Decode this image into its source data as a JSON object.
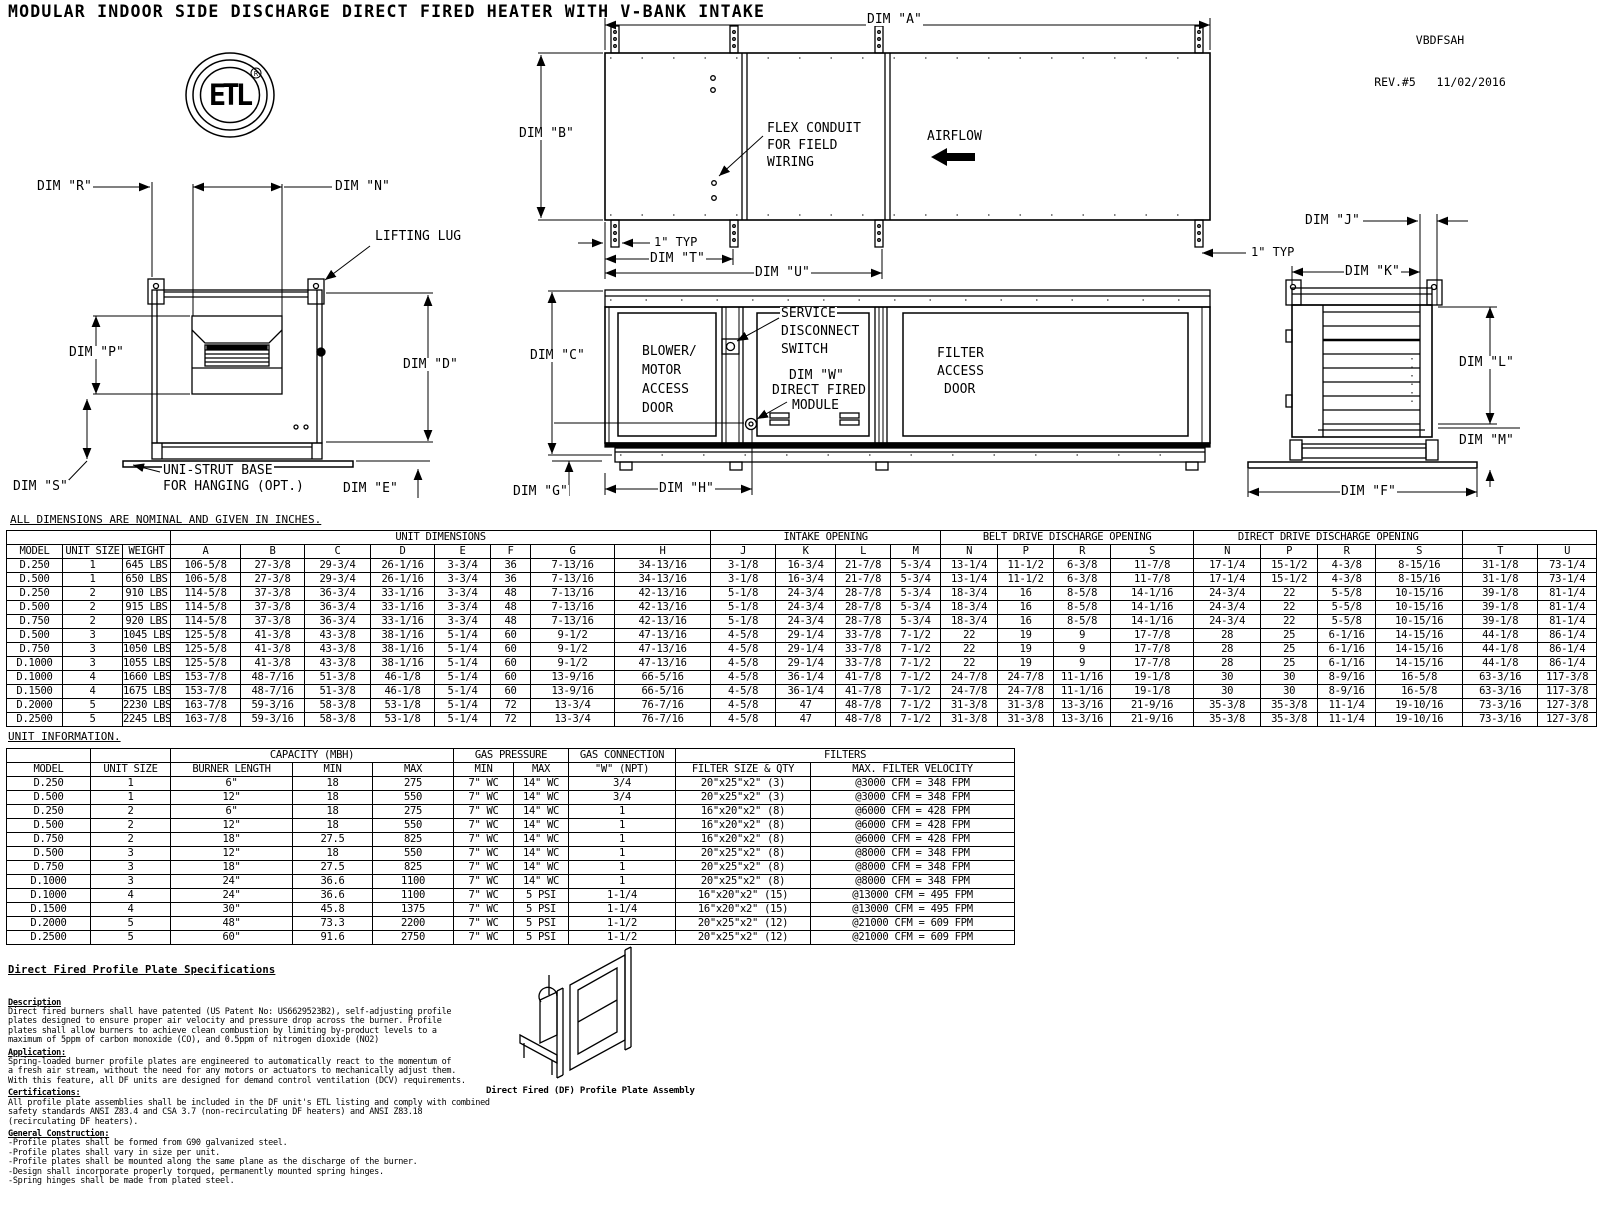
{
  "meta": {
    "title": "MODULAR INDOOR SIDE DISCHARGE DIRECT FIRED HEATER WITH V-BANK INTAKE",
    "doc_code": "VBDFSAH",
    "revision": "REV.#5   11/02/2016"
  },
  "logo": {
    "monogram": "ETL",
    "registered_mark": "R"
  },
  "notes": {
    "dimensions_note": "ALL DIMENSIONS ARE NOMINAL AND GIVEN IN INCHES.",
    "unit_info_note": "UNIT INFORMATION."
  },
  "drawing_labels": {
    "dim_r": "DIM \"R\"",
    "dim_n": "DIM \"N\"",
    "lifting_lug": "LIFTING LUG",
    "dim_p": "DIM \"P\"",
    "dim_d": "DIM \"D\"",
    "dim_s": "DIM \"S\"",
    "uni_strut_1": "UNI-STRUT BASE",
    "uni_strut_2": "FOR HANGING (OPT.)",
    "dim_e": "DIM \"E\"",
    "dim_a": "DIM \"A\"",
    "dim_b": "DIM \"B\"",
    "flex_1": "FLEX CONDUIT",
    "flex_2": "FOR FIELD",
    "flex_3": "WIRING",
    "airflow": "AIRFLOW",
    "typ_1": "1\" TYP",
    "dim_t": "DIM \"T\"",
    "dim_u": "DIM \"U\"",
    "dim_c": "DIM \"C\"",
    "blower_1": "BLOWER/",
    "blower_2": "MOTOR",
    "blower_3": "ACCESS",
    "blower_4": "DOOR",
    "service_1": "SERVICE",
    "service_2": "DISCONNECT",
    "service_3": "SWITCH",
    "dim_w": "DIM \"W\"",
    "df_1": "DIRECT FIRED",
    "df_2": "MODULE",
    "filter_1": "FILTER",
    "filter_2": "ACCESS",
    "filter_3": "DOOR",
    "dim_g": "DIM \"G\"",
    "dim_h": "DIM \"H\"",
    "dim_j": "DIM \"J\"",
    "typ_2": "1\" TYP",
    "dim_k": "DIM \"K\"",
    "dim_l": "DIM \"L\"",
    "dim_m": "DIM \"M\"",
    "dim_f": "DIM \"F\""
  },
  "dim_table": {
    "group_headers": [
      {
        "label": "",
        "span": 3
      },
      {
        "label": "UNIT DIMENSIONS",
        "span": 8
      },
      {
        "label": "INTAKE OPENING",
        "span": 4
      },
      {
        "label": "BELT DRIVE DISCHARGE OPENING",
        "span": 4
      },
      {
        "label": "DIRECT DRIVE DISCHARGE OPENING",
        "span": 4
      },
      {
        "label": "",
        "span": 2
      }
    ],
    "columns": [
      "MODEL",
      "UNIT SIZE",
      "WEIGHT",
      "A",
      "B",
      "C",
      "D",
      "E",
      "F",
      "G",
      "H",
      "J",
      "K",
      "L",
      "M",
      "N",
      "P",
      "R",
      "S",
      "N",
      "P",
      "R",
      "S",
      "T",
      "U"
    ],
    "rows": [
      [
        "D.250",
        "1",
        "645 LBS",
        "106-5/8",
        "27-3/8",
        "29-3/4",
        "26-1/16",
        "3-3/4",
        "36",
        "7-13/16",
        "34-13/16",
        "3-1/8",
        "16-3/4",
        "21-7/8",
        "5-3/4",
        "13-1/4",
        "11-1/2",
        "6-3/8",
        "11-7/8",
        "17-1/4",
        "15-1/2",
        "4-3/8",
        "8-15/16",
        "31-1/8",
        "73-1/4"
      ],
      [
        "D.500",
        "1",
        "650 LBS",
        "106-5/8",
        "27-3/8",
        "29-3/4",
        "26-1/16",
        "3-3/4",
        "36",
        "7-13/16",
        "34-13/16",
        "3-1/8",
        "16-3/4",
        "21-7/8",
        "5-3/4",
        "13-1/4",
        "11-1/2",
        "6-3/8",
        "11-7/8",
        "17-1/4",
        "15-1/2",
        "4-3/8",
        "8-15/16",
        "31-1/8",
        "73-1/4"
      ],
      [
        "D.250",
        "2",
        "910 LBS",
        "114-5/8",
        "37-3/8",
        "36-3/4",
        "33-1/16",
        "3-3/4",
        "48",
        "7-13/16",
        "42-13/16",
        "5-1/8",
        "24-3/4",
        "28-7/8",
        "5-3/4",
        "18-3/4",
        "16",
        "8-5/8",
        "14-1/16",
        "24-3/4",
        "22",
        "5-5/8",
        "10-15/16",
        "39-1/8",
        "81-1/4"
      ],
      [
        "D.500",
        "2",
        "915 LBS",
        "114-5/8",
        "37-3/8",
        "36-3/4",
        "33-1/16",
        "3-3/4",
        "48",
        "7-13/16",
        "42-13/16",
        "5-1/8",
        "24-3/4",
        "28-7/8",
        "5-3/4",
        "18-3/4",
        "16",
        "8-5/8",
        "14-1/16",
        "24-3/4",
        "22",
        "5-5/8",
        "10-15/16",
        "39-1/8",
        "81-1/4"
      ],
      [
        "D.750",
        "2",
        "920 LBS",
        "114-5/8",
        "37-3/8",
        "36-3/4",
        "33-1/16",
        "3-3/4",
        "48",
        "7-13/16",
        "42-13/16",
        "5-1/8",
        "24-3/4",
        "28-7/8",
        "5-3/4",
        "18-3/4",
        "16",
        "8-5/8",
        "14-1/16",
        "24-3/4",
        "22",
        "5-5/8",
        "10-15/16",
        "39-1/8",
        "81-1/4"
      ],
      [
        "D.500",
        "3",
        "1045 LBS",
        "125-5/8",
        "41-3/8",
        "43-3/8",
        "38-1/16",
        "5-1/4",
        "60",
        "9-1/2",
        "47-13/16",
        "4-5/8",
        "29-1/4",
        "33-7/8",
        "7-1/2",
        "22",
        "19",
        "9",
        "17-7/8",
        "28",
        "25",
        "6-1/16",
        "14-15/16",
        "44-1/8",
        "86-1/4"
      ],
      [
        "D.750",
        "3",
        "1050 LBS",
        "125-5/8",
        "41-3/8",
        "43-3/8",
        "38-1/16",
        "5-1/4",
        "60",
        "9-1/2",
        "47-13/16",
        "4-5/8",
        "29-1/4",
        "33-7/8",
        "7-1/2",
        "22",
        "19",
        "9",
        "17-7/8",
        "28",
        "25",
        "6-1/16",
        "14-15/16",
        "44-1/8",
        "86-1/4"
      ],
      [
        "D.1000",
        "3",
        "1055 LBS",
        "125-5/8",
        "41-3/8",
        "43-3/8",
        "38-1/16",
        "5-1/4",
        "60",
        "9-1/2",
        "47-13/16",
        "4-5/8",
        "29-1/4",
        "33-7/8",
        "7-1/2",
        "22",
        "19",
        "9",
        "17-7/8",
        "28",
        "25",
        "6-1/16",
        "14-15/16",
        "44-1/8",
        "86-1/4"
      ],
      [
        "D.1000",
        "4",
        "1660 LBS",
        "153-7/8",
        "48-7/16",
        "51-3/8",
        "46-1/8",
        "5-1/4",
        "60",
        "13-9/16",
        "66-5/16",
        "4-5/8",
        "36-1/4",
        "41-7/8",
        "7-1/2",
        "24-7/8",
        "24-7/8",
        "11-1/16",
        "19-1/8",
        "30",
        "30",
        "8-9/16",
        "16-5/8",
        "63-3/16",
        "117-3/8"
      ],
      [
        "D.1500",
        "4",
        "1675 LBS",
        "153-7/8",
        "48-7/16",
        "51-3/8",
        "46-1/8",
        "5-1/4",
        "60",
        "13-9/16",
        "66-5/16",
        "4-5/8",
        "36-1/4",
        "41-7/8",
        "7-1/2",
        "24-7/8",
        "24-7/8",
        "11-1/16",
        "19-1/8",
        "30",
        "30",
        "8-9/16",
        "16-5/8",
        "63-3/16",
        "117-3/8"
      ],
      [
        "D.2000",
        "5",
        "2230 LBS",
        "163-7/8",
        "59-3/16",
        "58-3/8",
        "53-1/8",
        "5-1/4",
        "72",
        "13-3/4",
        "76-7/16",
        "4-5/8",
        "47",
        "48-7/8",
        "7-1/2",
        "31-3/8",
        "31-3/8",
        "13-3/16",
        "21-9/16",
        "35-3/8",
        "35-3/8",
        "11-1/4",
        "19-10/16",
        "73-3/16",
        "127-3/8"
      ],
      [
        "D.2500",
        "5",
        "2245 LBS",
        "163-7/8",
        "59-3/16",
        "58-3/8",
        "53-1/8",
        "5-1/4",
        "72",
        "13-3/4",
        "76-7/16",
        "4-5/8",
        "47",
        "48-7/8",
        "7-1/2",
        "31-3/8",
        "31-3/8",
        "13-3/16",
        "21-9/16",
        "35-3/8",
        "35-3/8",
        "11-1/4",
        "19-10/16",
        "73-3/16",
        "127-3/8"
      ]
    ]
  },
  "info_table": {
    "group_headers": [
      {
        "label": "",
        "span": 1
      },
      {
        "label": "",
        "span": 1
      },
      {
        "label": "CAPACITY (MBH)",
        "span": 3
      },
      {
        "label": "GAS PRESSURE",
        "span": 2
      },
      {
        "label": "GAS CONNECTION",
        "span": 1
      },
      {
        "label": "FILTERS",
        "span": 2
      }
    ],
    "columns": [
      "MODEL",
      "UNIT SIZE",
      "BURNER LENGTH",
      "MIN",
      "MAX",
      "MIN",
      "MAX",
      "\"W\" (NPT)",
      "FILTER SIZE & QTY",
      "MAX. FILTER VELOCITY"
    ],
    "rows": [
      [
        "D.250",
        "1",
        "6\"",
        "18",
        "275",
        "7\" WC",
        "14\" WC",
        "3/4",
        "20\"x25\"x2\" (3)",
        "@3000 CFM = 348 FPM"
      ],
      [
        "D.500",
        "1",
        "12\"",
        "18",
        "550",
        "7\" WC",
        "14\" WC",
        "3/4",
        "20\"x25\"x2\" (3)",
        "@3000 CFM = 348 FPM"
      ],
      [
        "D.250",
        "2",
        "6\"",
        "18",
        "275",
        "7\" WC",
        "14\" WC",
        "1",
        "16\"x20\"x2\" (8)",
        "@6000 CFM = 428 FPM"
      ],
      [
        "D.500",
        "2",
        "12\"",
        "18",
        "550",
        "7\" WC",
        "14\" WC",
        "1",
        "16\"x20\"x2\" (8)",
        "@6000 CFM = 428 FPM"
      ],
      [
        "D.750",
        "2",
        "18\"",
        "27.5",
        "825",
        "7\" WC",
        "14\" WC",
        "1",
        "16\"x20\"x2\" (8)",
        "@6000 CFM = 428 FPM"
      ],
      [
        "D.500",
        "3",
        "12\"",
        "18",
        "550",
        "7\" WC",
        "14\" WC",
        "1",
        "20\"x25\"x2\" (8)",
        "@8000 CFM = 348 FPM"
      ],
      [
        "D.750",
        "3",
        "18\"",
        "27.5",
        "825",
        "7\" WC",
        "14\" WC",
        "1",
        "20\"x25\"x2\" (8)",
        "@8000 CFM = 348 FPM"
      ],
      [
        "D.1000",
        "3",
        "24\"",
        "36.6",
        "1100",
        "7\" WC",
        "14\" WC",
        "1",
        "20\"x25\"x2\" (8)",
        "@8000 CFM = 348 FPM"
      ],
      [
        "D.1000",
        "4",
        "24\"",
        "36.6",
        "1100",
        "7\" WC",
        "5 PSI",
        "1-1/4",
        "16\"x20\"x2\" (15)",
        "@13000 CFM = 495 FPM"
      ],
      [
        "D.1500",
        "4",
        "30\"",
        "45.8",
        "1375",
        "7\" WC",
        "5 PSI",
        "1-1/4",
        "16\"x20\"x2\" (15)",
        "@13000 CFM = 495 FPM"
      ],
      [
        "D.2000",
        "5",
        "48\"",
        "73.3",
        "2200",
        "7\" WC",
        "5 PSI",
        "1-1/2",
        "20\"x25\"x2\" (12)",
        "@21000 CFM = 609 FPM"
      ],
      [
        "D.2500",
        "5",
        "60\"",
        "91.6",
        "2750",
        "7\" WC",
        "5 PSI",
        "1-1/2",
        "20\"x25\"x2\" (12)",
        "@21000 CFM = 609 FPM"
      ]
    ]
  },
  "specs": {
    "heading": "Direct Fired Profile Plate Specifications",
    "sections": [
      {
        "title": "Description",
        "lines": [
          "Direct fired burners shall have patented (US Patent No: US6629523B2), self-adjusting profile",
          "plates designed to ensure proper air velocity and pressure drop across the burner. Profile",
          "plates shall allow burners to achieve clean combustion by limiting by-product levels to a",
          "maximum of 5ppm of carbon monoxide (CO), and 0.5ppm of nitrogen dioxide (NO2)"
        ]
      },
      {
        "title": "Application:",
        "lines": [
          "Spring-loaded burner profile plates are engineered to automatically react to the momentum of",
          "a fresh air stream, without the need for any motors or actuators to mechanically adjust them.",
          "With this feature, all DF units are designed for demand control ventilation (DCV) requirements."
        ]
      },
      {
        "title": "Certifications:",
        "lines": [
          "All profile plate assemblies shall be included in the DF unit's ETL listing and comply with combined",
          "safety standards ANSI Z83.4 and CSA 3.7 (non-recirculating DF heaters) and ANSI Z83.18",
          "(recirculating DF heaters)."
        ]
      },
      {
        "title": "General Construction:",
        "lines": [
          "-Profile plates shall be formed from G90 galvanized steel.",
          "-Profile plates shall vary in size per unit.",
          "-Profile plates shall be mounted along the same plane as the discharge of the burner.",
          "-Design shall incorporate properly torqued, permanently mounted spring hinges.",
          "-Spring hinges shall be made from plated steel."
        ]
      }
    ]
  },
  "assembly_caption": "Direct Fired (DF) Profile Plate Assembly"
}
